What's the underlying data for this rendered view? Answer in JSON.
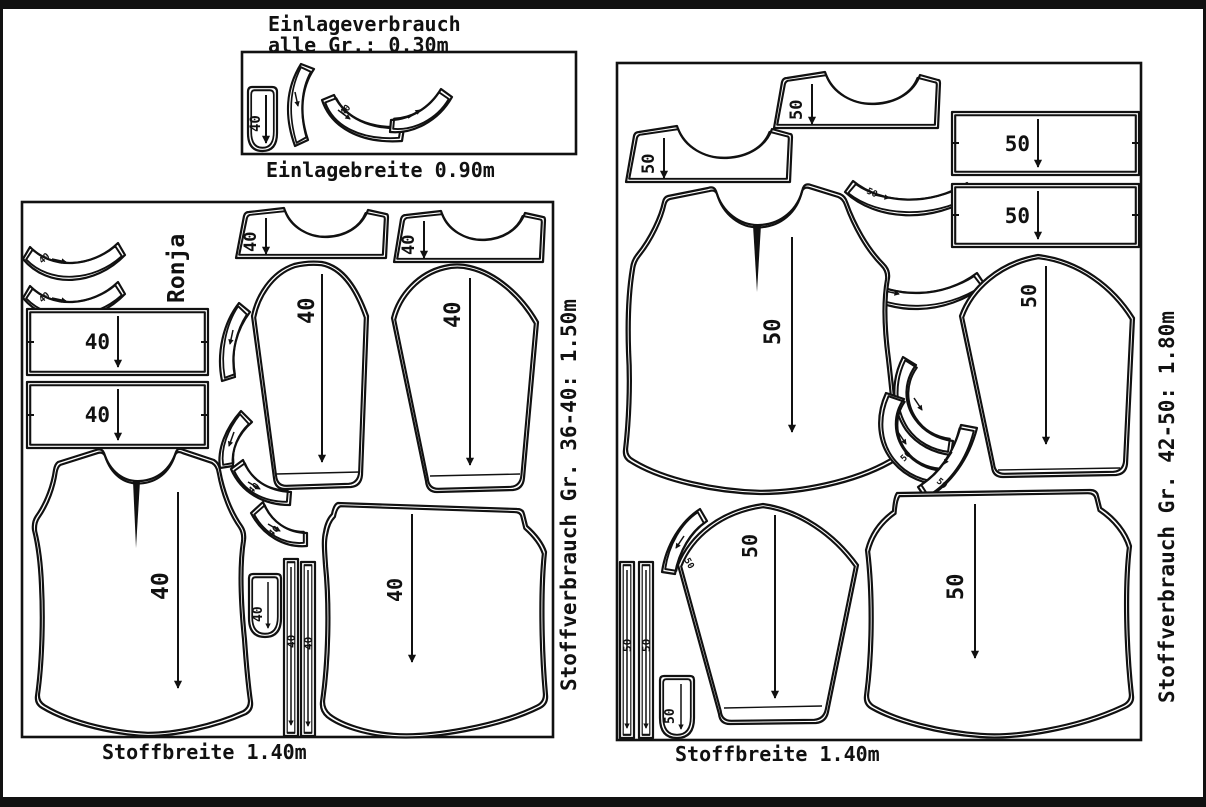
{
  "header": {
    "line1": "Einlageverbrauch",
    "line2": "alle Gr.: 0.30m",
    "width_label": "Einlagebreite 0.90m"
  },
  "pattern_name": "Ronja",
  "panels": {
    "left": {
      "size": "40",
      "fabric_usage": "Stoffverbrauch Gr. 36-40: 1.50m",
      "fabric_width": "Stoffbreite 1.40m"
    },
    "right": {
      "size": "50",
      "fabric_usage": "Stoffverbrauch Gr. 42-50: 1.80m",
      "fabric_width": "Stoffbreite 1.40m"
    }
  },
  "colors": {
    "line": "#111111",
    "background": "#ffffff"
  }
}
